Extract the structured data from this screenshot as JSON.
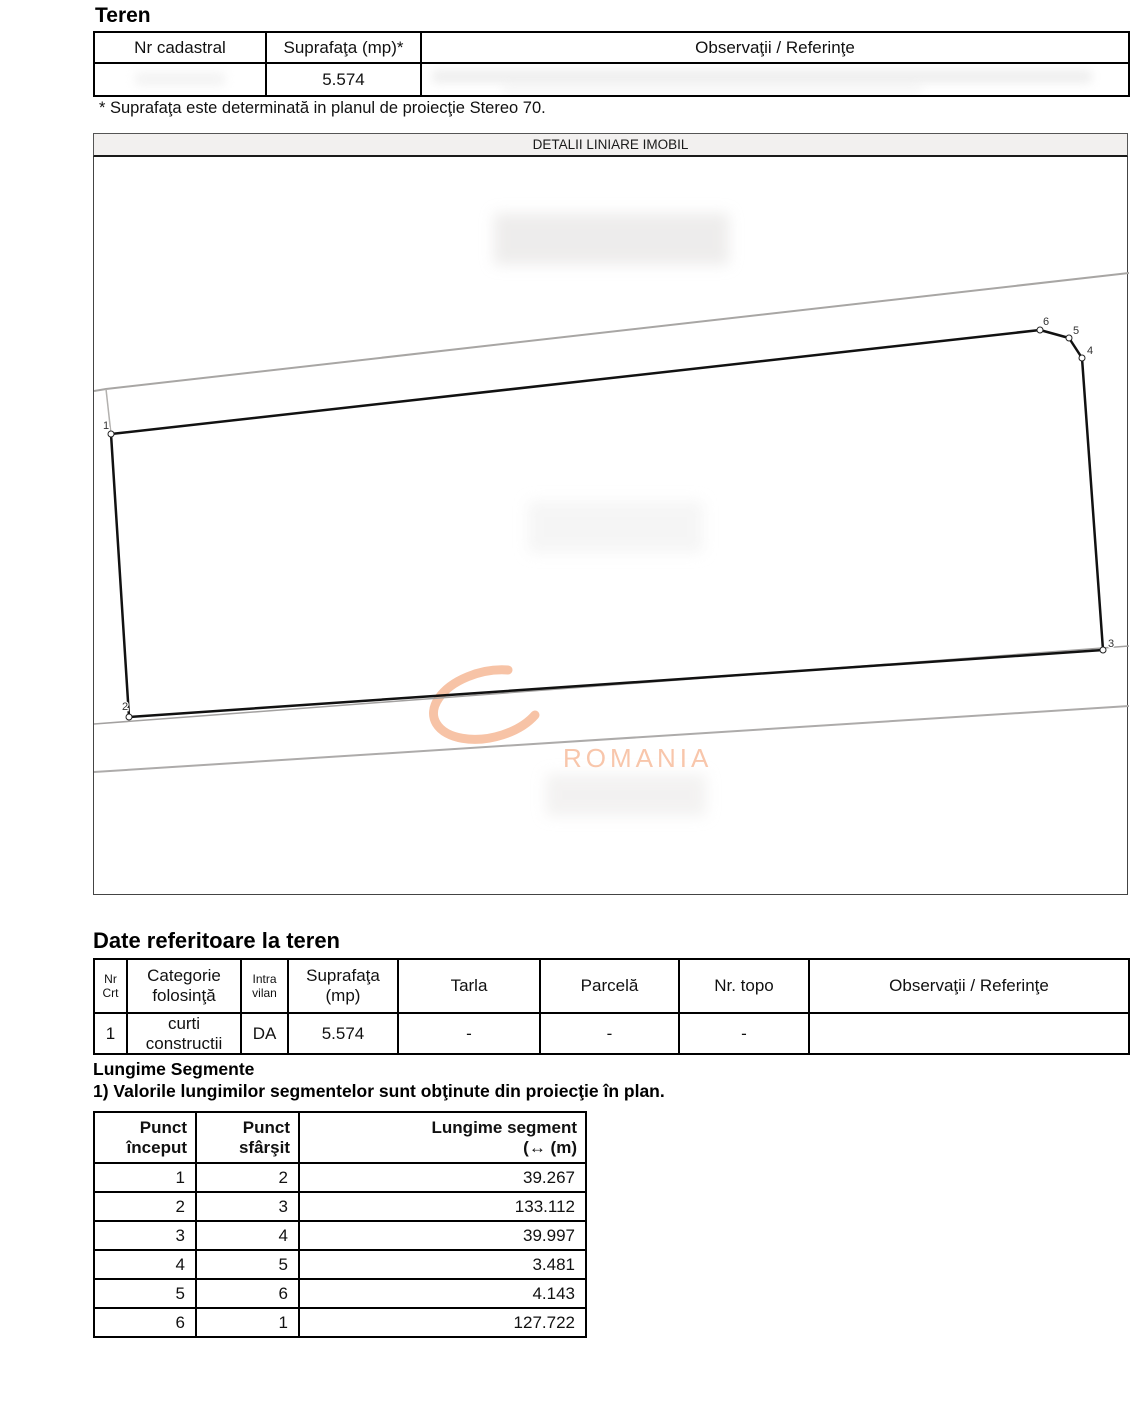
{
  "teren": {
    "title": "Teren",
    "table": {
      "col_nr_cadastral": "Nr cadastral",
      "col_suprafata": "Suprafaţa (mp)*",
      "col_observatii": "Observaţii / Referinţe",
      "row_suprafata": "5.574"
    },
    "note": "* Suprafaţa este determinată in planul de proiecţie Stereo 70."
  },
  "map": {
    "title": "DETALII LINIARE IMOBIL",
    "watermark_text": "ROMANIA",
    "vertex_labels": [
      "1",
      "2",
      "3",
      "4",
      "5",
      "6"
    ]
  },
  "date_teren": {
    "title": "Date referitoare la teren",
    "headers": {
      "nr_crt": "Nr\nCrt",
      "categorie": "Categorie\nfolosinţă",
      "intravilan": "Intra\nvilan",
      "suprafata": "Suprafaţa\n(mp)",
      "tarla": "Tarla",
      "parcela": "Parcelă",
      "nr_topo": "Nr. topo",
      "observatii": "Observaţii / Referinţe"
    },
    "row": {
      "nr_crt": "1",
      "categorie": "curti\nconstructii",
      "intravilan": "DA",
      "suprafata": "5.574",
      "tarla": "-",
      "parcela": "-",
      "nr_topo": "-",
      "observatii": ""
    }
  },
  "segments": {
    "title": "Lungime Segmente",
    "note": "1) Valorile lungimilor segmentelor sunt obţinute din proiecţie în plan.",
    "headers": {
      "start": "Punct\nînceput",
      "end": "Punct\nsfârşit",
      "length": "Lungime segment\n(↔ (m)"
    },
    "rows": [
      {
        "start": "1",
        "end": "2",
        "length": "39.267"
      },
      {
        "start": "2",
        "end": "3",
        "length": "133.112"
      },
      {
        "start": "3",
        "end": "4",
        "length": "39.997"
      },
      {
        "start": "4",
        "end": "5",
        "length": "3.481"
      },
      {
        "start": "5",
        "end": "6",
        "length": "4.143"
      },
      {
        "start": "6",
        "end": "1",
        "length": "127.722"
      }
    ]
  },
  "colors": {
    "watermark": "#f7c3a6",
    "map_gray_line": "#a8a6a4",
    "border": "#000000"
  }
}
